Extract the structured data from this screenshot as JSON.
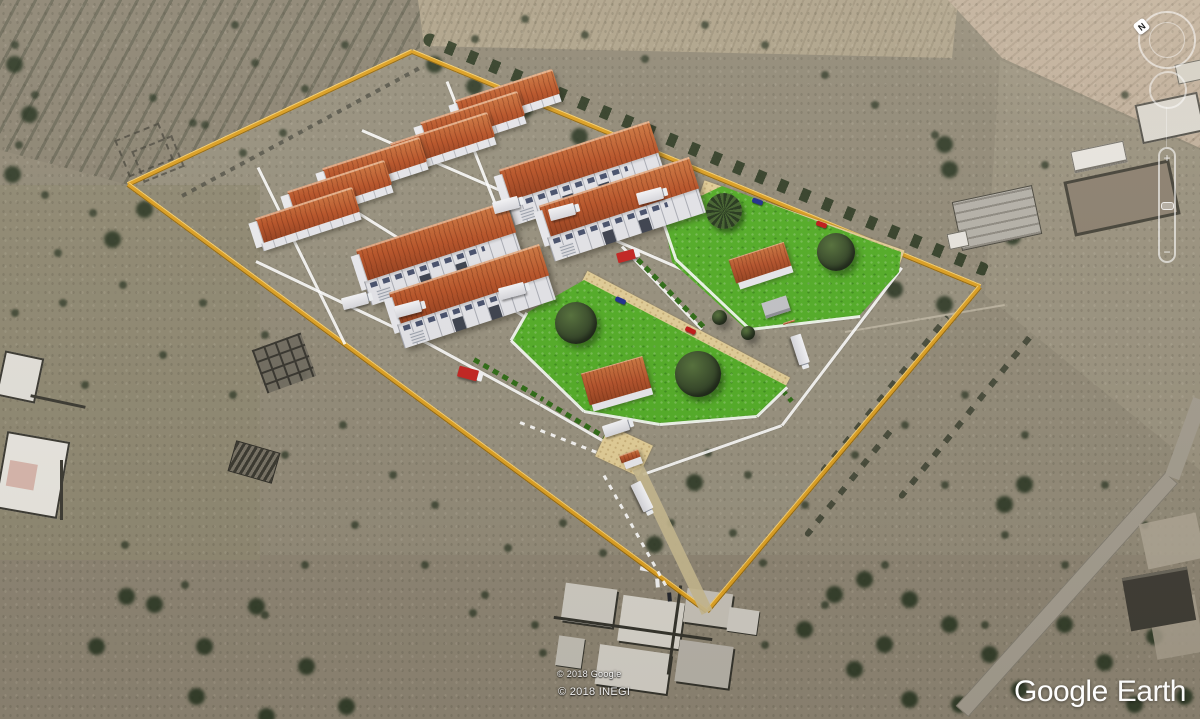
{
  "app": {
    "name": "Google Earth"
  },
  "watermark": {
    "brand": "Google",
    "product": "Earth"
  },
  "attribution": {
    "line1": "© 2018 Google",
    "line2": "© 2018 INEGI"
  },
  "controls": {
    "compass_label": "N",
    "zoom_in": "+",
    "zoom_out": "−"
  },
  "colors": {
    "site_boundary": "#E2A21E",
    "lawn": "#53AD26",
    "roof_tile": "#B5522A",
    "building_wall": "#E8E8EC",
    "sand_road": "#E2CD96",
    "terrain": "#938B78",
    "vegetation": "#2F3B26",
    "truck_red": "#C42420",
    "car_blue": "#1E2F8C",
    "car_red": "#C01818"
  },
  "scene": {
    "type": "3d-site-plan-overlay-on-satellite",
    "large_warehouses": 4,
    "small_sheds": 6,
    "lawn_parcels": 2,
    "office_buildings": 2,
    "gatehouses": 1
  }
}
